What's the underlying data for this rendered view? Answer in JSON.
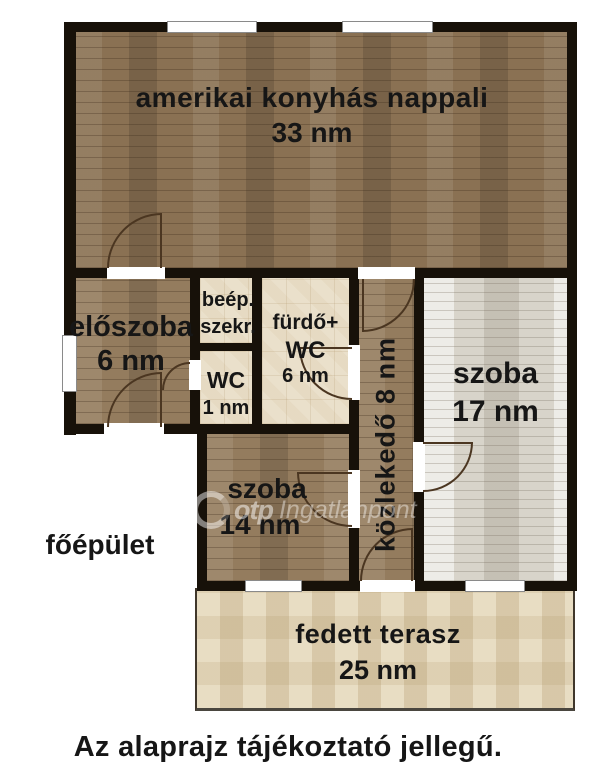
{
  "rooms": {
    "nappali": {
      "name": "amerikai konyhás nappali",
      "area": "33 nm"
    },
    "eloszoba": {
      "name": "előszoba",
      "area": "6 nm"
    },
    "szekreny": {
      "name_line1": "beép.",
      "name_line2": "szekr."
    },
    "wc": {
      "name": "WC",
      "area": "1 nm"
    },
    "furdo": {
      "name_line1": "fürdő+",
      "name_line2": "WC",
      "area": "6 nm"
    },
    "kozlekedo": {
      "label": "közlekedő 8 nm"
    },
    "szoba17": {
      "name": "szoba",
      "area": "17 nm"
    },
    "szoba14": {
      "name": "szoba",
      "area": "14 nm"
    },
    "terasz": {
      "name": "fedett terasz",
      "area": "25 nm"
    }
  },
  "labels": {
    "building": "főépület",
    "caption": "Az alaprajz tájékoztató jellegű."
  },
  "watermark": {
    "brand": "otp",
    "name": "Ingatlanpont"
  },
  "colors": {
    "wall": "#171109",
    "wood": "#947c5e",
    "wood_dark": "#8a7153",
    "wood_light": "#d8d4ca",
    "tile": "#eae0cb",
    "terrace": "#e8ddc3",
    "arc": "#4b3621"
  }
}
